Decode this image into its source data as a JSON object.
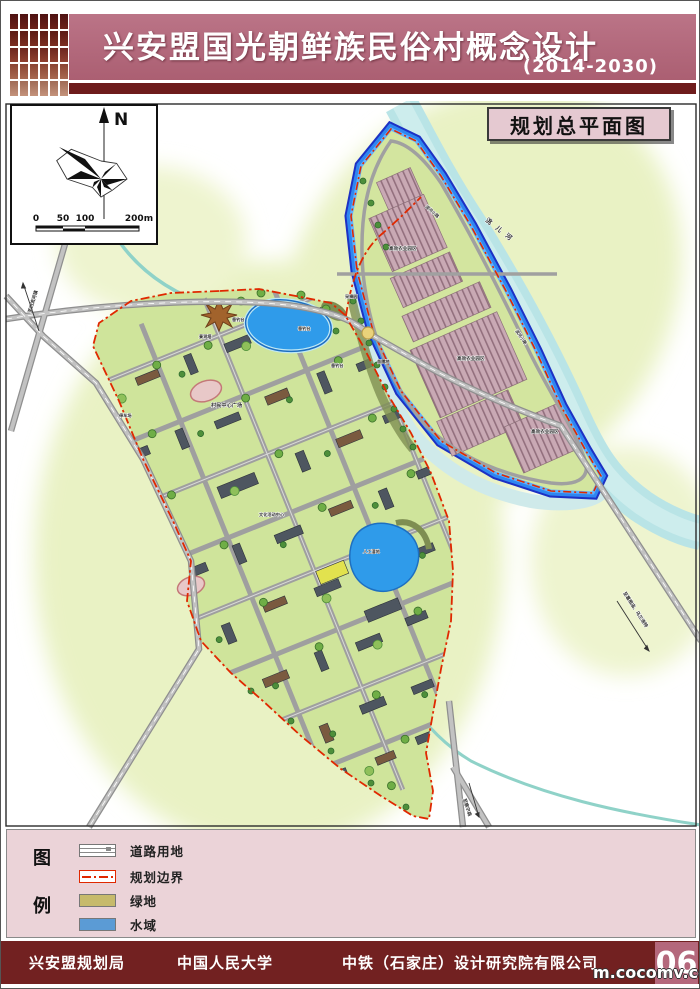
{
  "header": {
    "title": "兴安盟国光朝鲜族民俗村概念设计",
    "period": "(2014-2030)"
  },
  "map": {
    "plan_title": "规划总平面图",
    "compass": {
      "north": "N",
      "ticks": [
        "0",
        "50",
        "100",
        "200m"
      ]
    },
    "labels": [
      {
        "text": "洮儿河"
      },
      {
        "text": "滨河小路"
      },
      {
        "text": "滨河小路"
      },
      {
        "text": "高效农业园区"
      },
      {
        "text": "高效农业园区"
      },
      {
        "text": "高效农业园区"
      },
      {
        "text": "垂钓台"
      },
      {
        "text": "垂钓台"
      },
      {
        "text": "垂钓台"
      },
      {
        "text": "景观塔"
      },
      {
        "text": "村民中心广场"
      },
      {
        "text": "停车场"
      },
      {
        "text": "采摘园"
      },
      {
        "text": "苗圃地"
      },
      {
        "text": "人工湿地"
      },
      {
        "text": "文化活动中心"
      },
      {
        "text": "至归流河镇"
      },
      {
        "text": "至葛根庙、乌兰浩特"
      },
      {
        "text": "至察尔森"
      }
    ]
  },
  "legend": {
    "head_top": "图",
    "head_bottom": "例",
    "items": [
      {
        "label": "道路用地"
      },
      {
        "label": "规划边界"
      },
      {
        "label": "绿地",
        "swatch_style": "background:#c6ba6b"
      },
      {
        "label": "水域",
        "swatch_style": "background:#5b9bd5"
      }
    ]
  },
  "footer": {
    "orgs": [
      "兴安盟规划局",
      "中国人民大学",
      "中铁（石家庄）设计研究院有限公司"
    ],
    "page_no": "06"
  },
  "watermark": "m.cocomv.com",
  "colors": {
    "header_band": "#b2697b",
    "header_strip": "#6e1c1c",
    "boundary_red": "#e02800",
    "water_blue": "#2f9bea",
    "river_cyan": "#b9e4e6",
    "green_land": "#cfe49b",
    "field_pink": "#c9a9b4",
    "footer_maroon": "#722121",
    "page_no_bg": "#b4687c"
  }
}
